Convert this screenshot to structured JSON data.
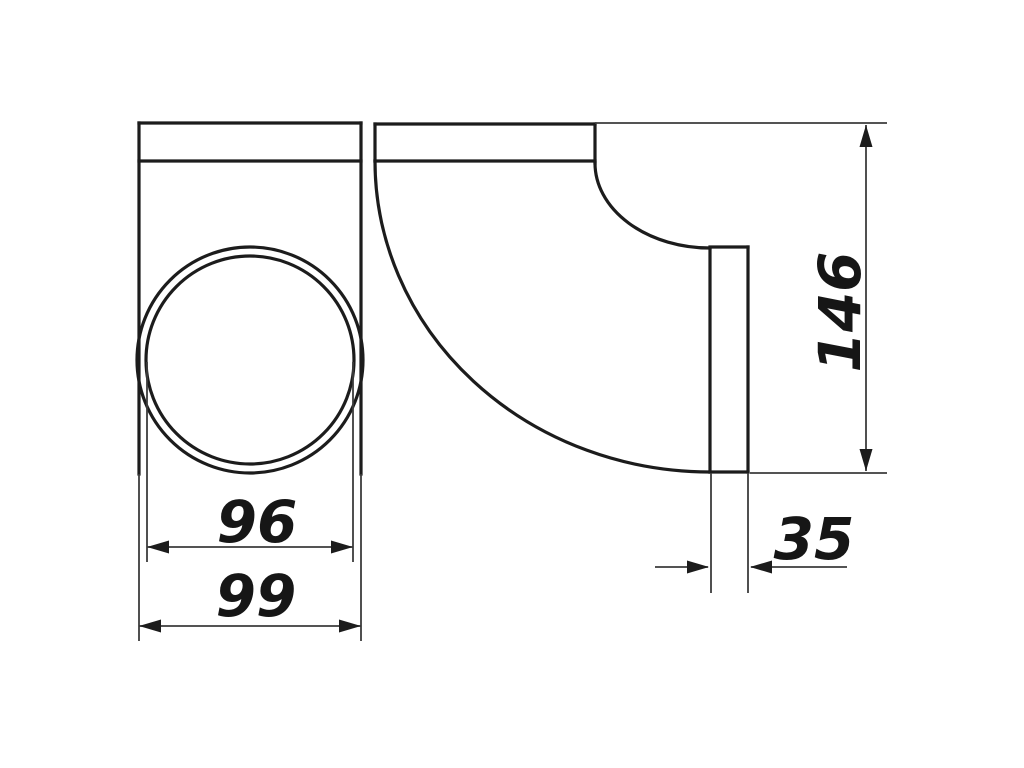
{
  "drawing": {
    "type": "technical-drawing-duct-elbow",
    "dimensions": {
      "inner_diameter": "96",
      "outer_width": "99",
      "height": "146",
      "spigot_width": "35"
    }
  },
  "colors": {
    "background": "#ffffff",
    "part_line": "#1c1c1c",
    "thin_line": "#3c3c3c",
    "text": "#161616"
  }
}
